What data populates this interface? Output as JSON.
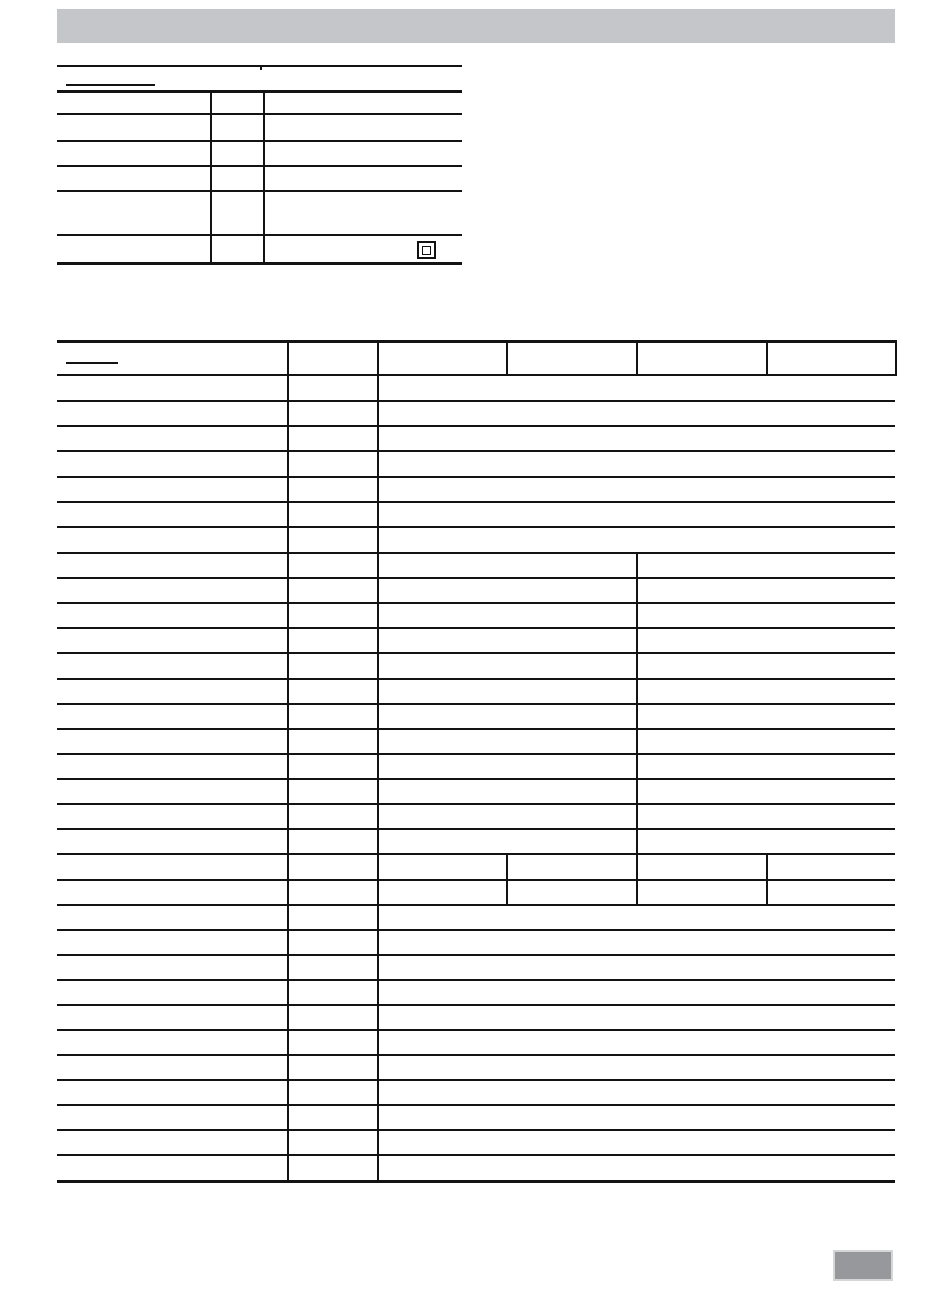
{
  "page": {
    "description": "Blank specification / technical data page from an appliance manual scan; tables contain no printed text",
    "background_color": "#ffffff",
    "line_color": "#131313"
  },
  "header_bar": {
    "label": "",
    "color": "#c5c6c9"
  },
  "top_rule": {
    "y": 65,
    "segments": [
      {
        "x1": 57,
        "x2": 260
      },
      {
        "x1": 261,
        "x2": 462
      }
    ],
    "tick": {
      "x": 260,
      "y": 65,
      "w": 1.5,
      "h": 5
    }
  },
  "underline_placeholders": [
    {
      "name": "top-table-heading-underline",
      "x": 66,
      "y": 84,
      "w": 89
    },
    {
      "name": "main-table-heading-underline",
      "x": 66,
      "y": 362,
      "w": 52
    }
  ],
  "top_table": {
    "heading_text": "",
    "left": 57,
    "right": 462,
    "row_lines": [
      90,
      113,
      140,
      165,
      190,
      234,
      262
    ],
    "vertical_segments": [
      {
        "x": 210,
        "y1": 90,
        "y2": 262
      },
      {
        "x": 263,
        "y1": 90,
        "y2": 262
      }
    ],
    "rows": 6,
    "columns": 3,
    "cells_text": [
      "",
      "",
      "",
      "",
      "",
      "",
      "",
      "",
      "",
      "",
      "",
      "",
      "",
      "",
      "",
      "",
      "",
      ""
    ],
    "icon_in_last_row": "class-ii-double-square-icon"
  },
  "main_table": {
    "heading_text": "",
    "left": 57,
    "right": 895,
    "row_lines": [
      340,
      374,
      400,
      425,
      450,
      476,
      501,
      526,
      552,
      577,
      602,
      627,
      652,
      678,
      703,
      728,
      753,
      778,
      803,
      828,
      853,
      879,
      904,
      929,
      954,
      979,
      1004,
      1029,
      1054,
      1079,
      1104,
      1129,
      1154,
      1180
    ],
    "vertical_segments": [
      {
        "x": 287,
        "y1": 340,
        "y2": 1180
      },
      {
        "x": 377,
        "y1": 340,
        "y2": 1180
      },
      {
        "x": 506,
        "y1": 340,
        "y2": 374
      },
      {
        "x": 636,
        "y1": 340,
        "y2": 374
      },
      {
        "x": 766,
        "y1": 340,
        "y2": 374
      },
      {
        "x": 895,
        "y1": 340,
        "y2": 374
      },
      {
        "x": 636,
        "y1": 552,
        "y2": 853
      },
      {
        "x": 506,
        "y1": 853,
        "y2": 904
      },
      {
        "x": 636,
        "y1": 853,
        "y2": 904
      },
      {
        "x": 766,
        "y1": 853,
        "y2": 904
      }
    ],
    "header_columns": 6,
    "sections": [
      {
        "name": "header-row",
        "rows": 1,
        "columns": 6
      },
      {
        "name": "merged-wide-rows-a",
        "rows": 7,
        "columns": 3
      },
      {
        "name": "two-value-rows-b",
        "rows": 12,
        "columns": 4
      },
      {
        "name": "full-column-rows-c",
        "rows": 2,
        "columns": 6
      },
      {
        "name": "merged-wide-rows-d",
        "rows": 11,
        "columns": 3
      }
    ],
    "cells_text_note": "all cells are empty / no printed text visible"
  },
  "footer_box": {
    "label": "",
    "fill_color": "#97989b",
    "border_color": "#d6d6d8"
  },
  "icons": {
    "class_ii_double_square_icon": "square inside a square (double-insulation symbol)"
  }
}
